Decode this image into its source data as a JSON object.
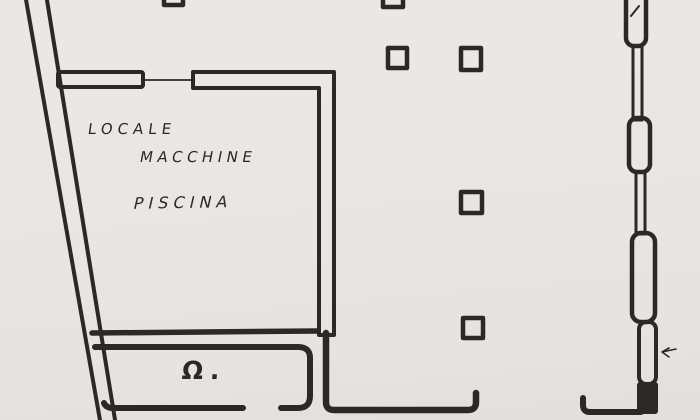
{
  "page": {
    "kind": "scanned hand-drawn floor plan",
    "paper_color": "#e9e7e4",
    "ink_color": "#2b2926"
  },
  "plan": {
    "machine_room": {
      "line1": "LOCALE",
      "line2": "MACCHINE",
      "line3": "PISCINA"
    },
    "small_room": {
      "label": "Ω."
    },
    "features": {
      "pillar_count": 6,
      "window_symbol_count": 4,
      "door_opening_count": 4
    }
  }
}
